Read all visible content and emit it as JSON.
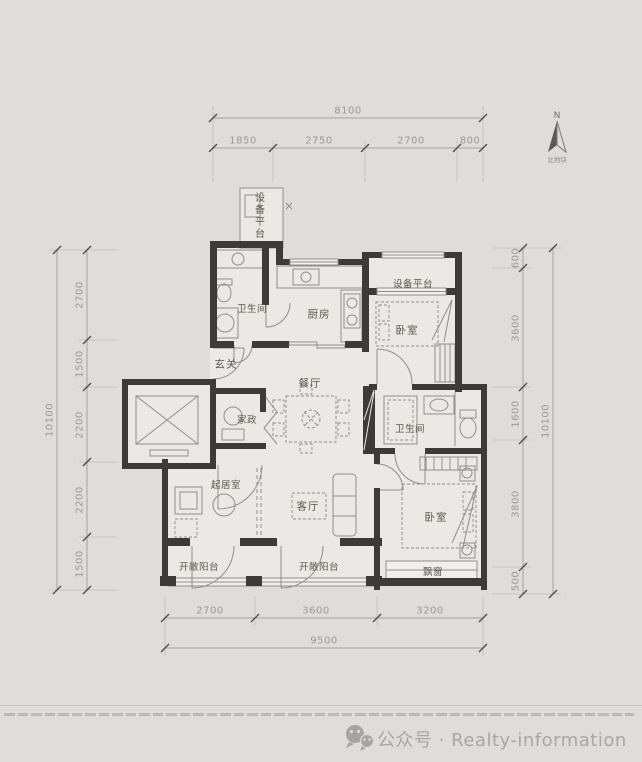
{
  "palette": {
    "background": "#dedddb",
    "room_fill": "#ebe9e5",
    "wall": "#3c3b39",
    "thin_line": "#8f8e8b",
    "dim_line": "#a5a4a1",
    "dim_text": "#9a9995",
    "label_text": "#57564f",
    "footer_text": "#a8a7a4"
  },
  "north": {
    "label": "N",
    "caption": "北地块"
  },
  "rooms": {
    "equip_top": {
      "label": "设备平台"
    },
    "bath_main": {
      "label": "卫生间"
    },
    "kitchen": {
      "label": "厨房"
    },
    "equip_right": {
      "label": "设备平台"
    },
    "bedroom_top": {
      "label": "卧室"
    },
    "entry": {
      "label": "玄关"
    },
    "dining": {
      "label": "餐厅"
    },
    "housekeeping": {
      "label": "家政"
    },
    "bath_second": {
      "label": "卫生间"
    },
    "sitting": {
      "label": "起居室"
    },
    "living": {
      "label": "客厅"
    },
    "bedroom_bottom": {
      "label": "卧室"
    },
    "bay_window": {
      "label": "飘窗"
    },
    "balcony_left": {
      "label": "开敞阳台"
    },
    "balcony_right": {
      "label": "开敞阳台"
    }
  },
  "dims": {
    "top": {
      "total": "8100",
      "segments": [
        "1850",
        "2750",
        "2700",
        "800"
      ]
    },
    "bottom": {
      "total": "9500",
      "segments": [
        "2700",
        "3600",
        "3200"
      ]
    },
    "left": {
      "total": "10100",
      "segments": [
        "2700",
        "1500",
        "2200",
        "2200",
        "1500"
      ]
    },
    "right": {
      "total": "10100",
      "segments": [
        "600",
        "3600",
        "1600",
        "3800",
        "500"
      ]
    }
  },
  "footer": {
    "brand": "公众号 · Realty-information"
  }
}
